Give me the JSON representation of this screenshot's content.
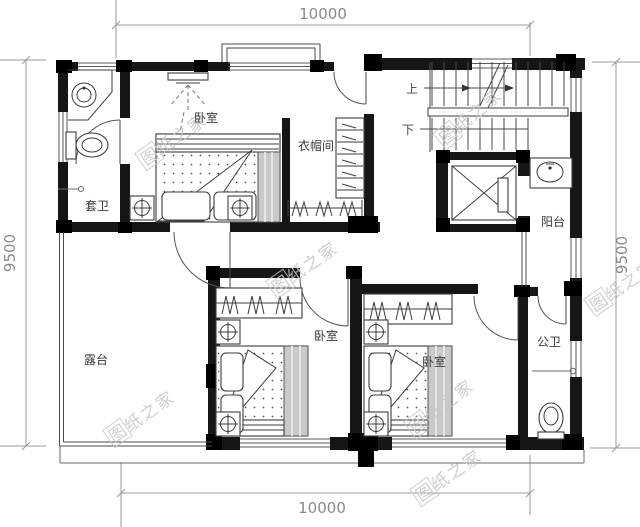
{
  "dimensions": {
    "top": "10000",
    "bottom": "10000",
    "left": "9500",
    "right": "9500"
  },
  "labels": {
    "master_bedroom": "卧室",
    "cloakroom": "衣帽间",
    "ensuite_bath": "套卫",
    "balcony": "阳台",
    "terrace": "露台",
    "bedroom_2": "卧室",
    "bedroom_3": "卧室",
    "public_bath": "公卫",
    "stairs_up": "上",
    "stairs_down": "下"
  },
  "watermark": {
    "text": "图纸之家",
    "color": "#c6c6c6",
    "instances": [
      {
        "x": 173,
        "y": 140,
        "rot": -35
      },
      {
        "x": 470,
        "y": 117,
        "rot": -40
      },
      {
        "x": 304,
        "y": 268,
        "rot": -35
      },
      {
        "x": 141,
        "y": 417,
        "rot": -35
      },
      {
        "x": 441,
        "y": 407,
        "rot": -38
      },
      {
        "x": 622,
        "y": 286,
        "rot": -35
      },
      {
        "x": 448,
        "y": 476,
        "rot": -35
      }
    ]
  }
}
